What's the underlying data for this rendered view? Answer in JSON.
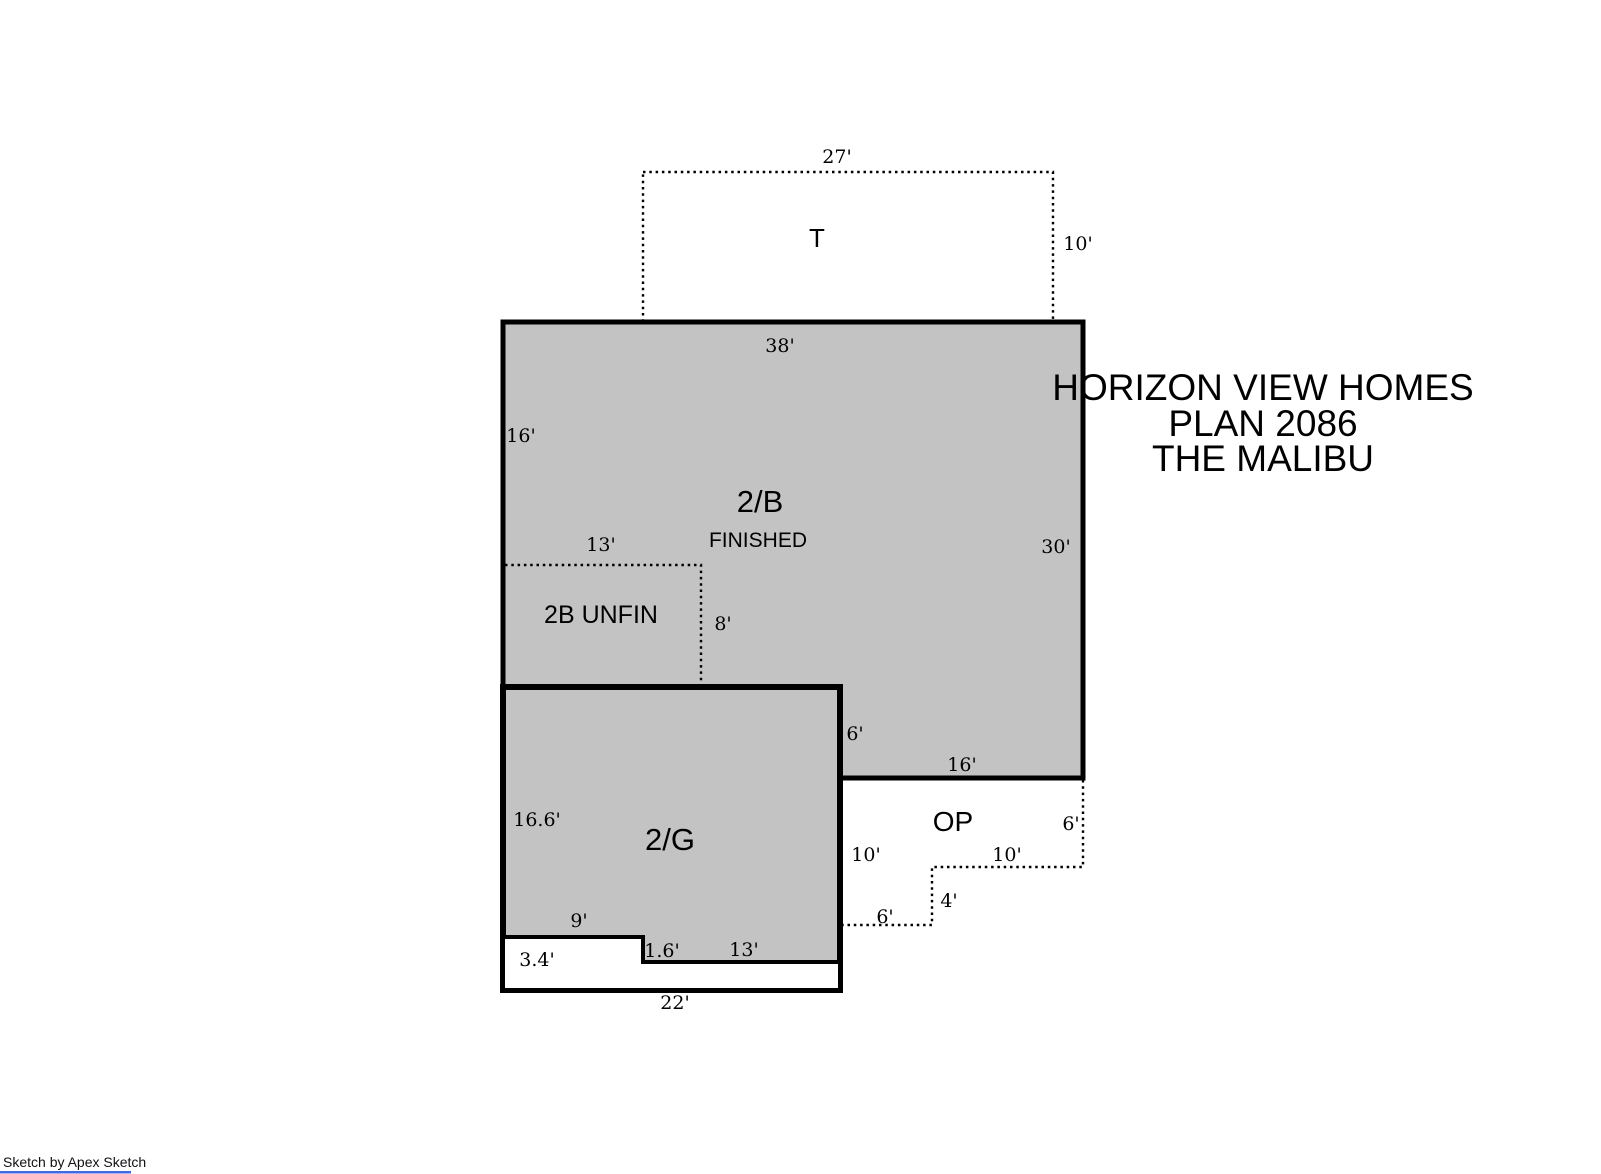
{
  "title": {
    "line1": "HORIZON VIEW HOMES",
    "line2": "PLAN 2086",
    "line3": "THE MALIBU"
  },
  "watermark": "Sketch by Apex Sketch",
  "colors": {
    "area_fill": "#c3c3c3",
    "outline": "#000000",
    "watermark_underline": "#4169e1"
  },
  "areas": {
    "t": {
      "label": "T",
      "dims": {
        "top": "27'",
        "right": "10'"
      }
    },
    "b2": {
      "label": "2/B",
      "sublabel": "FINISHED",
      "dims": {
        "top": "38'",
        "left_upper": "16'",
        "right": "30'",
        "bottom_right": "16'",
        "step_right": "6'"
      }
    },
    "b2_unfin": {
      "label": "2B UNFIN",
      "dims": {
        "top": "13'",
        "right": "8'"
      }
    },
    "g2": {
      "label": "2/G",
      "dims": {
        "left": "16.6'",
        "notch_top": "9'",
        "notch_left": "3.4'",
        "notch_step": "1.6'",
        "bottom_inner": "13'",
        "bottom": "22'"
      }
    },
    "op": {
      "label": "OP",
      "dims": {
        "left": "10'",
        "right": "6'",
        "mid": "10'",
        "step_v": "4'",
        "step_h": "6'"
      }
    }
  }
}
